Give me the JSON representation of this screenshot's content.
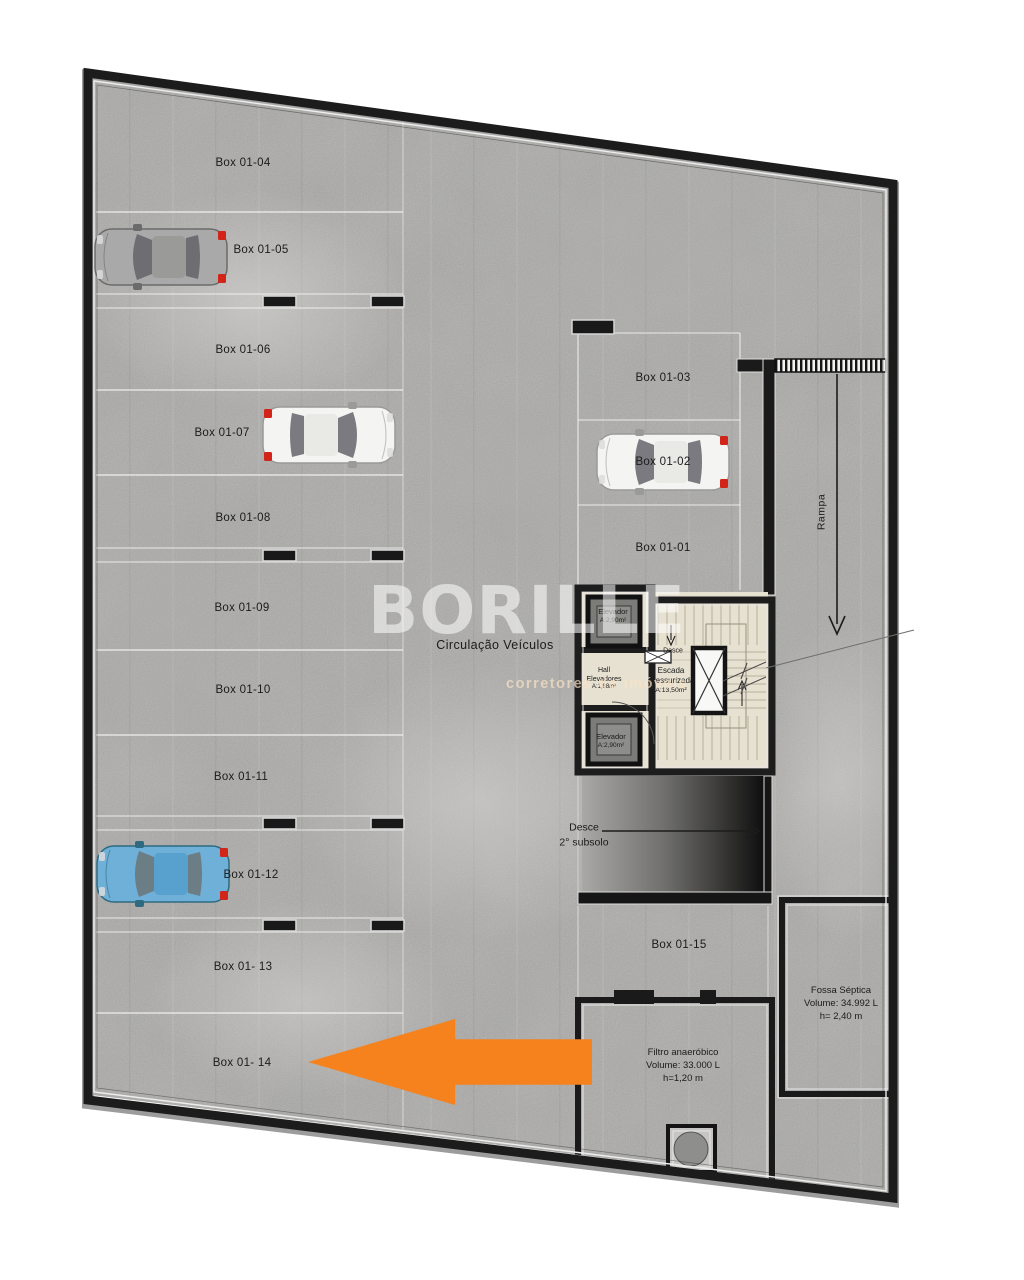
{
  "stalls": {
    "left": [
      "Box 01-04",
      "Box 01-05",
      "Box 01-06",
      "Box 01-07",
      "Box 01-08",
      "Box 01-09",
      "Box 01-10",
      "Box 01-11",
      "Box 01-12",
      "Box 01- 13",
      "Box 01- 14"
    ],
    "right": [
      "Box 01-03",
      "Box 01-02",
      "Box 01-01"
    ],
    "lower": "Box 01-15"
  },
  "circulation_label": "Circulação Veículos",
  "core": {
    "elevator_top": {
      "name": "Elevador",
      "area": "A:2,90m²"
    },
    "elevator_bottom": {
      "name": "Elevador",
      "area": "A:2,90m²"
    },
    "hall": {
      "line1": "Hall",
      "line2": "Elevadores",
      "area": "A:1,88m²"
    },
    "stair": {
      "desce": "Desce",
      "line1": "Escada",
      "line2": "Pressurizada",
      "area": "A:13,50m²"
    }
  },
  "ramp_label": "Rampa",
  "subsolo": {
    "line1": "Desce",
    "line2": "2° subsolo"
  },
  "fossa": {
    "line1": "Fossa Séptica",
    "line2": "Volume: 34.992 L",
    "line3": "h= 2,40 m"
  },
  "filtro": {
    "line1": "Filtro anaeróbico",
    "line2": "Volume: 33.000 L",
    "line3": "h=1,20 m"
  },
  "watermark": {
    "brand": "BORILLE",
    "tagline": "corretores de imóveis"
  },
  "colors": {
    "highlight_arrow": "#F6821E",
    "wall": "#1C1C1C",
    "floor": "#CAC9C7",
    "stair_floor": "#E7E1D2",
    "car_gray": "#A9A9A9",
    "car_white": "#F4F4F2",
    "car_blue": "#6FB0D8"
  }
}
